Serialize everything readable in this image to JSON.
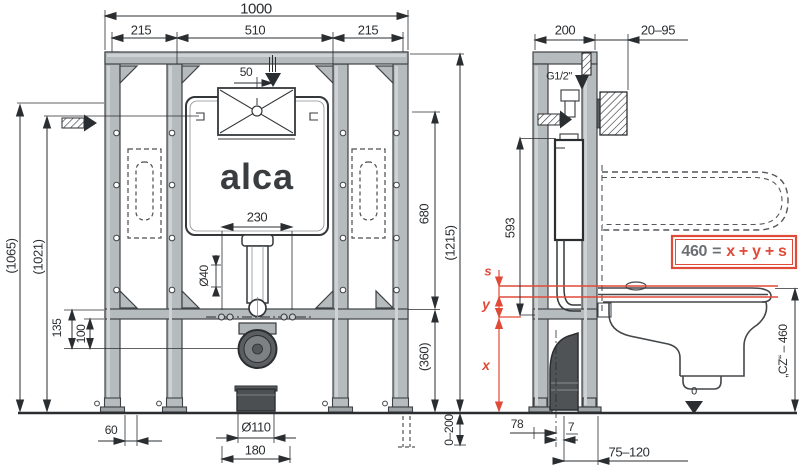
{
  "brand": {
    "logo": "alca"
  },
  "front": {
    "width_total": "1000",
    "width_left": "215",
    "width_center": "510",
    "width_right": "215",
    "flush_offset": "50",
    "stud_spacing": "230",
    "flush_pipe_dia": "Ø40",
    "height_total": "(1065)",
    "height_tab": "(1021)",
    "elbow_upper": "135",
    "elbow_lower": "100",
    "foot_offset": "60",
    "drain_dia": "Ø110",
    "drain_spacing": "180",
    "rail_floor": "(360)",
    "plate_span": "680",
    "frame_height": "(1215)",
    "leg_adjust": "0–200"
  },
  "side": {
    "depth": "200",
    "wall_offset": "20–95",
    "supply_thread": "G1/2\"",
    "valve_height": "593",
    "drain_center": "78",
    "drain_gap": "7",
    "outlet_height": "75–120",
    "seat_height": "„CZ“ – 460",
    "floor_datum": "0",
    "formula_left": "460",
    "formula_eq": "=",
    "formula_right": "x + y + s",
    "dim_s": "s",
    "dim_y": "y",
    "dim_x": "x"
  },
  "colors": {
    "red": "#e04a38",
    "line": "#2b2e31",
    "steel": "#b6bbbd"
  }
}
